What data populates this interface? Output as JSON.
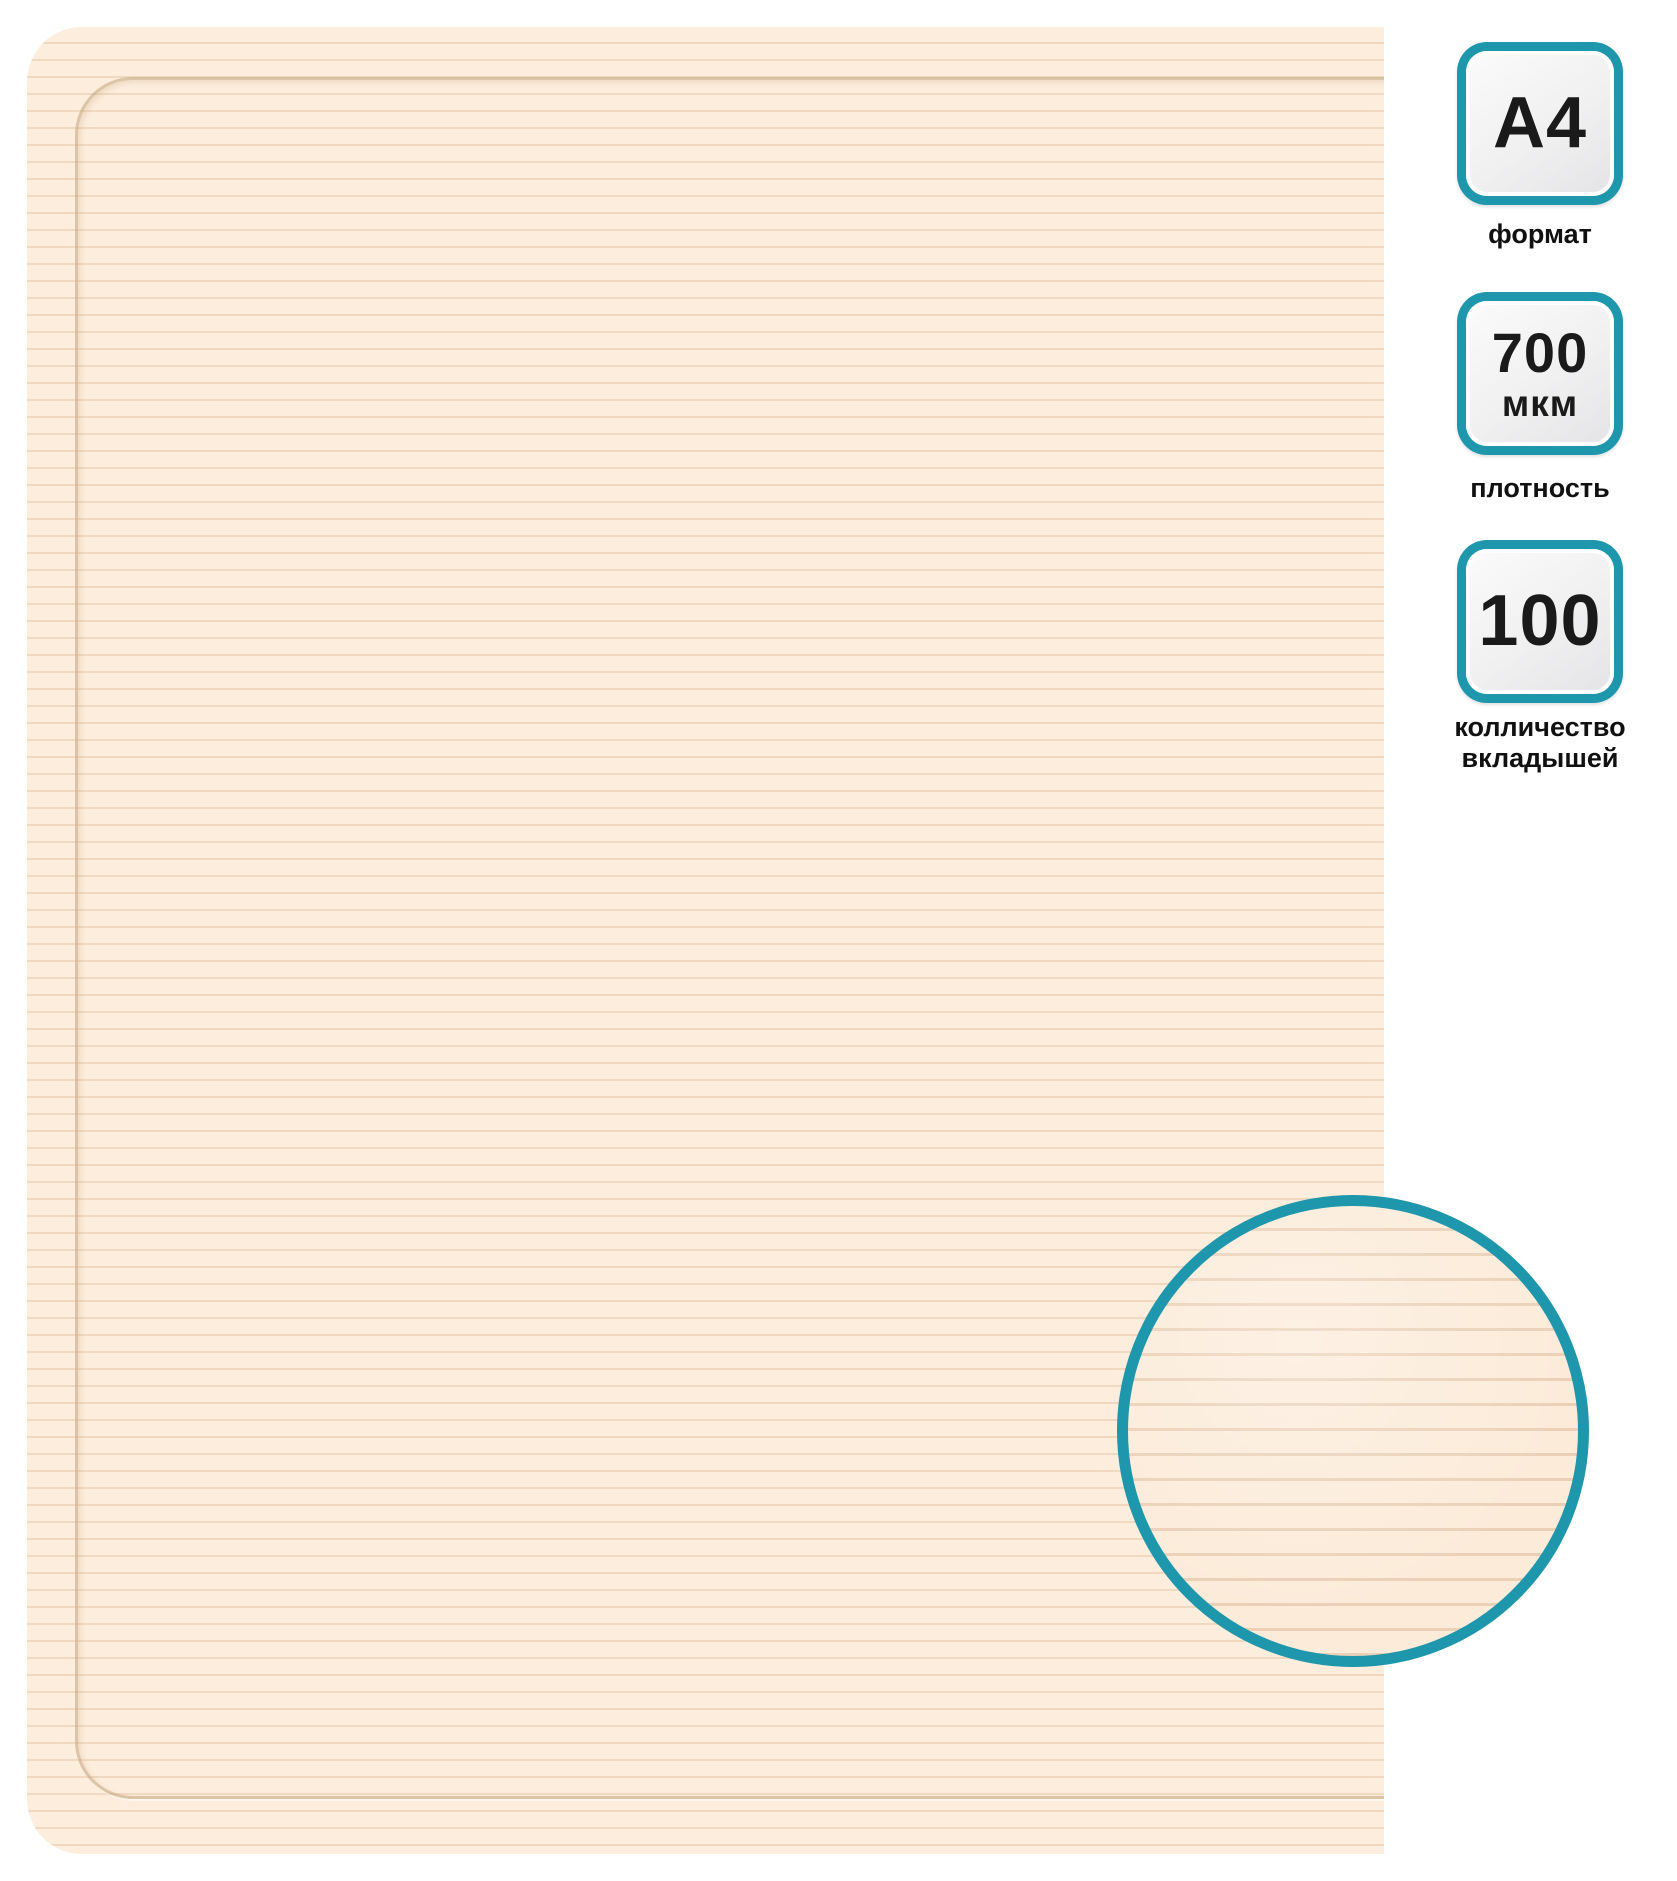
{
  "colors": {
    "background": "#ffffff",
    "accent_teal": "#1e96ac",
    "sheet_base": "#fceddc",
    "sheet_stripe": "#debA98",
    "badge_fill_light": "#fbfbfb",
    "badge_fill_dark": "#e4e4e6",
    "badge_text": "#1a1a1a"
  },
  "sheet": {
    "texture": "horizontal-ribbed-cream-sheet"
  },
  "badges": [
    {
      "value": "A4",
      "unit": "",
      "label": "формат"
    },
    {
      "value": "700",
      "unit": "мкм",
      "label": "плотность"
    },
    {
      "value": "100",
      "unit": "",
      "label": "колличество вкладышей"
    }
  ]
}
